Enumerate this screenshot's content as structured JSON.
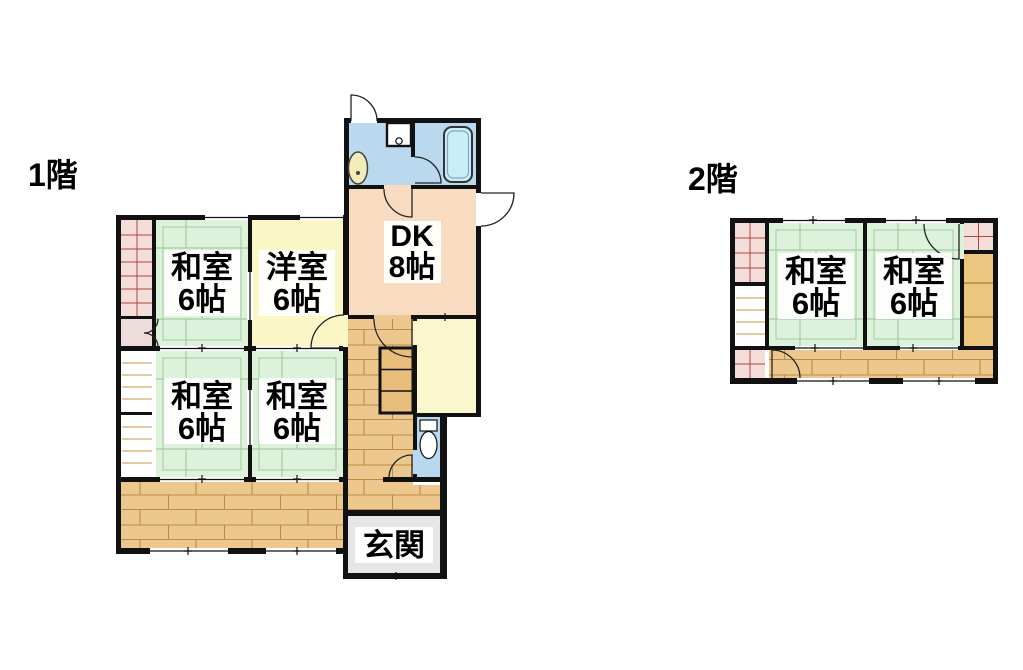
{
  "document": {
    "type": "floor-plan",
    "floors": [
      {
        "label": "1階",
        "rooms": [
          {
            "id": "washitsu-1f-nw",
            "name": "和室",
            "size": "6帖"
          },
          {
            "id": "youshitsu-1f",
            "name": "洋室",
            "size": "6帖"
          },
          {
            "id": "dk-1f",
            "name": "DK",
            "size": "8帖"
          },
          {
            "id": "washitsu-1f-sw",
            "name": "和室",
            "size": "6帖"
          },
          {
            "id": "washitsu-1f-s",
            "name": "和室",
            "size": "6帖"
          },
          {
            "id": "genkan-1f",
            "name": "玄関"
          }
        ],
        "fixtures": [
          "washing-machine",
          "sink",
          "bathtub",
          "toilet",
          "staircase",
          "closets",
          "veranda"
        ]
      },
      {
        "label": "2階",
        "rooms": [
          {
            "id": "washitsu-2f-w",
            "name": "和室",
            "size": "6帖"
          },
          {
            "id": "washitsu-2f-e",
            "name": "和室",
            "size": "6帖"
          }
        ],
        "fixtures": [
          "staircase",
          "closets",
          "hallway"
        ]
      }
    ],
    "palette": {
      "tatami_green": "#dcf2da",
      "tatami_line": "#a3cba3",
      "western_yellow": "#faf6c6",
      "small_room_yellow": "#faf6ce",
      "dk_peach": "#f8dcc2",
      "wood_floor": "#ecc88e",
      "wood_line": "#bd8c44",
      "stair_tan": "#e9be7c",
      "bath_blue": "#bbd9ee",
      "toilet_blue": "#b8d8f0",
      "tub_cyan": "#cbedf8",
      "genkan_gray": "#e6e6e6",
      "closet_pink": "#f2ddd9",
      "closet_hatch_red": "#b5443c",
      "wall_black": "#111111"
    },
    "icons": {
      "bathtub-icon": "rounded-rect",
      "washing-machine-icon": "square-with-circle",
      "sink-icon": "oval-basin",
      "toilet-icon": "tank-and-bowl",
      "stairs-icon": "striped-box",
      "door-icon": "quarter-arc",
      "closet-icon": "hatched-grid",
      "window-icon": "double-line-gap"
    }
  }
}
